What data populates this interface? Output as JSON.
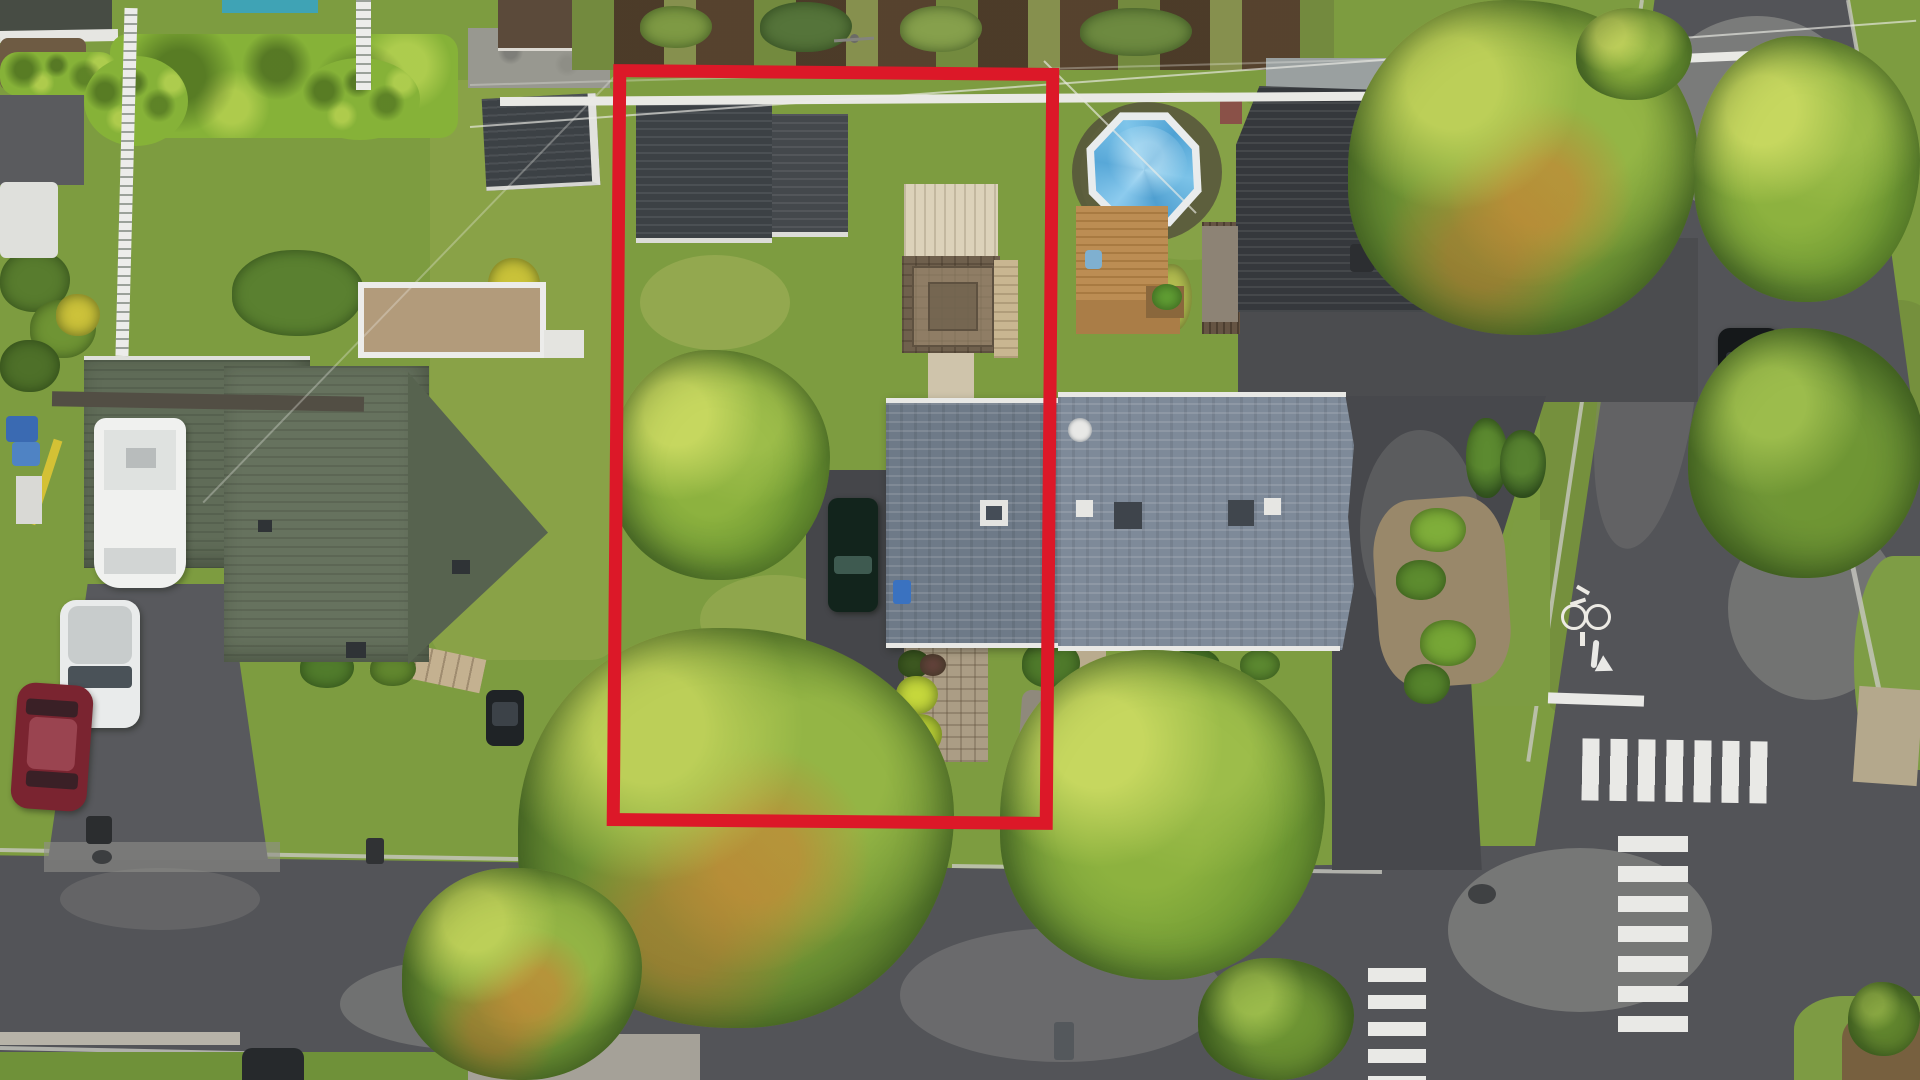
{
  "scene": {
    "kind": "aerial-drone-photograph",
    "setting": "top-down view of a suburban residential neighborhood with a red outline highlighting one property lot",
    "annotation_outline": {
      "label": "highlighted property lot boundary",
      "color": "#dc1828",
      "shape": "rectangle"
    },
    "palette": {
      "grass": "#7d9c40",
      "asphalt_road": "#535458",
      "driveway": "#47484c",
      "roof_blue_gray_left": "#6e7a88",
      "roof_blue_gray_right": "#7e8a99",
      "roof_olive_left_house": "#606c58",
      "roof_dark_house": "#35383c",
      "shed_roof": "#3c4145",
      "pool_cover_blue": "#53a7d8",
      "pool_rim_white": "#e9eced",
      "wood_deck": "#b98a52",
      "pergola_pavers": "#8b7b64",
      "road_marking_white": "#e9e9e6",
      "hedge_green": "#86b238",
      "maroon_car": "#7a2430",
      "white_suv": "#e9ebeb"
    },
    "labels": {
      "scene": "aerial view of suburban lots, streets and trees",
      "red_outline": "red property boundary outline",
      "vegetable_garden": "backyard vegetable garden beds",
      "hedge": "trimmed green hedge row",
      "shed_left": "neighbor garden shed",
      "shed_lot": "dark-roof shed inside highlighted lot",
      "backyard_deck": "light backyard deck platform",
      "pergola": "paver-pattern pergola / gazebo roof",
      "lot_house": "highlighted lot house (blue-gray shingle roof)",
      "neighbor_house": "neighbor house (light blue-gray shingle roof)",
      "dark_roof_house": "neighbor house with dark charcoal roof",
      "pool": "above-ground pool with blue cover",
      "pool_deck": "wooden pool deck",
      "left_house": "large house with olive-gray roof",
      "balcony_deck": "rooftop deck with white railing",
      "rv": "white RV / camper trailer",
      "white_suv": "white SUV in driveway",
      "maroon_car": "maroon sedan in driveway",
      "driveway_car": "dark car in highlighted-lot driveway",
      "street_car": "dark car parked at street edge",
      "parked_car_road": "dark car parked along side street",
      "green_utility_boxes": "green utility boxes at curb",
      "storm_drain": "storm drain grate",
      "bike_symbol": "painted bicycle lane symbol",
      "turn_arrow": "painted right-turn arrow",
      "stop_line": "painted stop line",
      "crosswalk_main": "zebra crosswalk across side street",
      "crosswalk_right": "ladder crosswalk across main street",
      "crosswalk_lower": "crosswalk partially under tree",
      "street": "main street in front of houses",
      "side_street": "side street joining at intersection",
      "trees": "large deciduous street trees",
      "white_fence": "white backyard fence line",
      "power_lines": "overhead power lines",
      "trash_bins": "curbside trash bins",
      "grass_island": "grass corner island with curb"
    }
  }
}
